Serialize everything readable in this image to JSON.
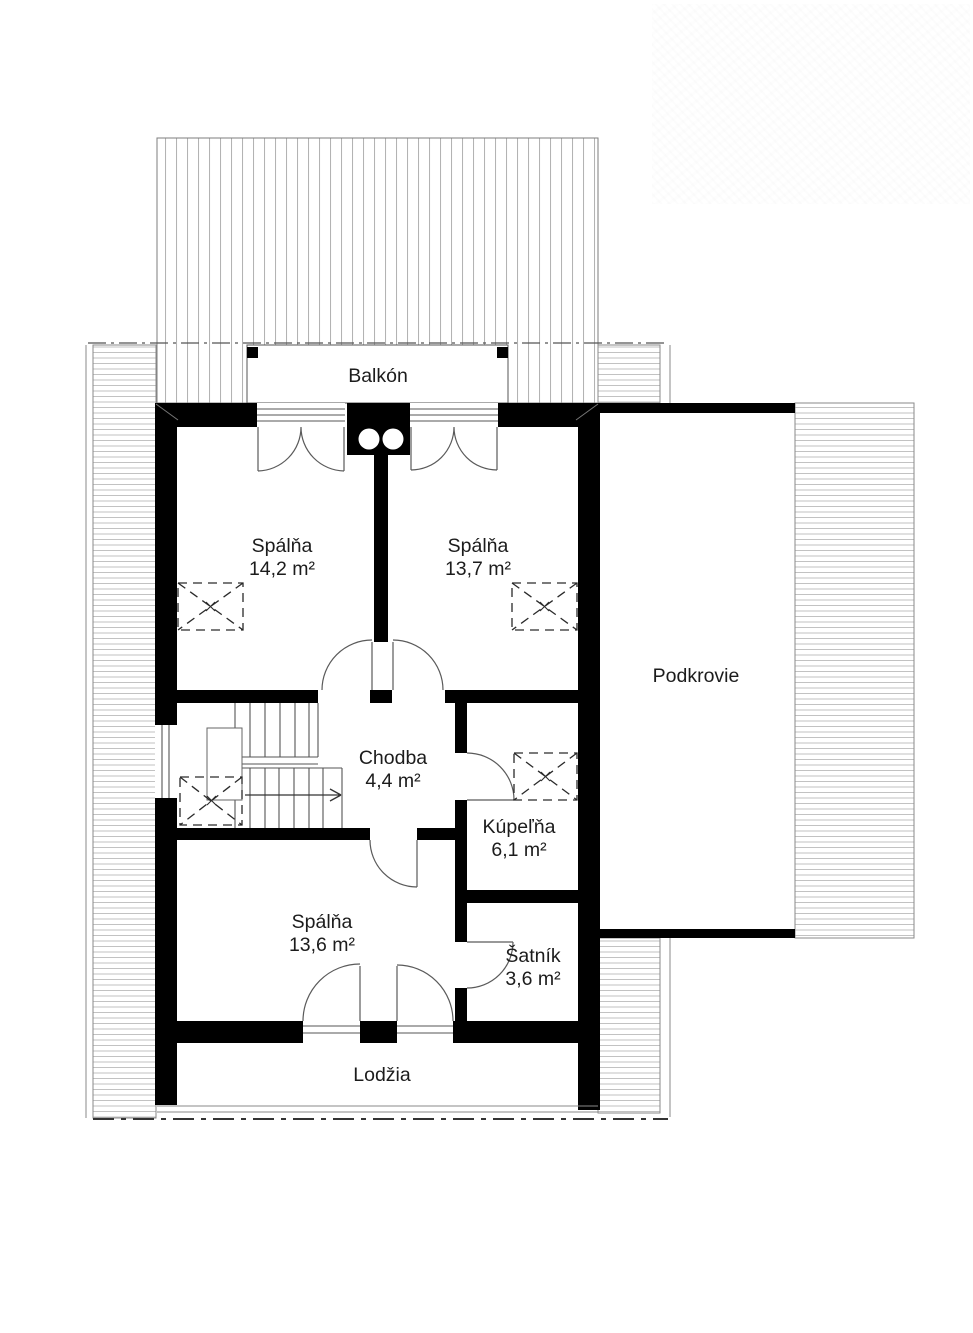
{
  "plan": {
    "floor_type": "floor-plan",
    "colors": {
      "wall": "#000000",
      "hatch": "#b3b3b3",
      "text": "#1c1c1c",
      "background": "#ffffff"
    },
    "rooms": {
      "balkon": {
        "name": "Balkón"
      },
      "spalna1": {
        "name": "Spálňa",
        "area": "14,2 m²"
      },
      "spalna2": {
        "name": "Spálňa",
        "area": "13,7 m²"
      },
      "podkrovie": {
        "name": "Podkrovie"
      },
      "chodba": {
        "name": "Chodba",
        "area": "4,4 m²"
      },
      "kupelna": {
        "name": "Kúpeľňa",
        "area": "6,1 m²"
      },
      "spalna3": {
        "name": "Spálňa",
        "area": "13,6 m²"
      },
      "satnik": {
        "name": "Šatník",
        "area": "3,6 m²"
      },
      "lodzia": {
        "name": "Lodžia"
      }
    }
  }
}
